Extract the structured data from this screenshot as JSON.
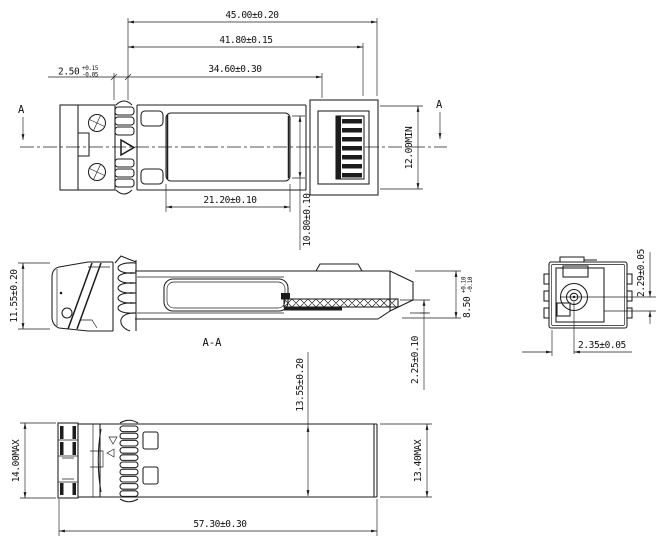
{
  "drawing": {
    "background": "#ffffff",
    "line_color": "#1c1c1c",
    "views": {
      "top_view": {
        "name": "top-view",
        "section_label_left": "A",
        "section_label_right": "A",
        "dim_overall_length": "45.00±0.20",
        "dim_shield_length": "41.80±0.15",
        "dim_body_length": "34.60±0.30",
        "dim_front_offset_value": "2.50",
        "dim_front_offset_tol_upper": "+0.15",
        "dim_front_offset_tol_lower": "-0.05",
        "dim_window_length": "21.20±0.10",
        "dim_window_width": "10.80±0.10",
        "dim_min_clearance": "12.00MIN"
      },
      "section_view": {
        "name": "section-view",
        "label": "A-A",
        "dim_height": "11.55±0.20",
        "dim_pcb_height_value": "8.50",
        "dim_pcb_height_tol_upper": "+0.10",
        "dim_pcb_height_tol_lower": "-0.10",
        "dim_pcb_offset": "2.25±0.10",
        "dim_overall_height": "13.55±0.20"
      },
      "end_view": {
        "name": "end-view",
        "dim_axis_vertical": "2.29±0.05",
        "dim_axis_horizontal": "2.35±0.05"
      },
      "bottom_view": {
        "name": "bottom-view",
        "dim_max_height": "14.00MAX",
        "dim_body_height": "13.40MAX",
        "dim_overall_length": "57.30±0.30"
      }
    }
  }
}
